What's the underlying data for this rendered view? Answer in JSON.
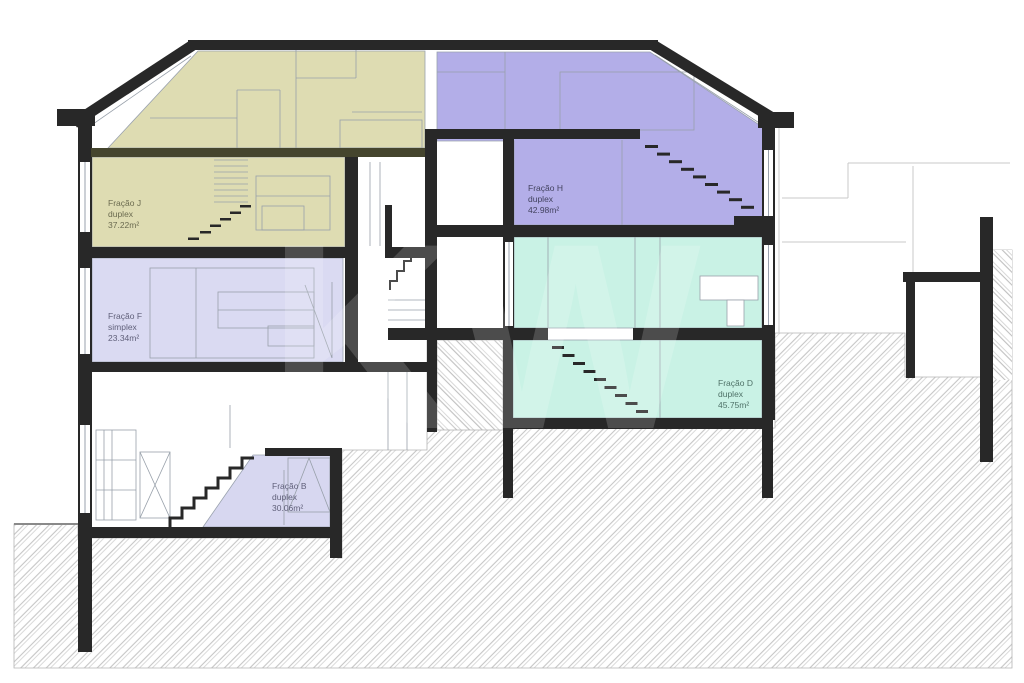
{
  "drawing": {
    "kind": "building cross-section",
    "watermark": "KW"
  },
  "colors": {
    "wall": "#282828",
    "attic_slab": "#45452e",
    "background": "#ffffff",
    "hatch_line": "#c6c6c6",
    "furniture_line": "#98a0aa",
    "neighbor_line": "#c9c9c9"
  },
  "units": [
    {
      "name": "Fração J",
      "type": "duplex",
      "area": "37.22m²",
      "color": "#dedcb2",
      "label_color": "#6b6b50"
    },
    {
      "name": "Fração F",
      "type": "simplex",
      "area": "23.34m²",
      "color": "#dadaf2",
      "label_color": "#60607a"
    },
    {
      "name": "Fração H",
      "type": "duplex",
      "area": "42.98m²",
      "color": "#b3aee8",
      "label_color": "#42425f"
    },
    {
      "name": "Fração D",
      "type": "duplex",
      "area": "45.75m²",
      "color": "#c9f2e5",
      "label_color": "#4f7268"
    },
    {
      "name": "Fração B",
      "type": "duplex",
      "area": "30.06m²",
      "color": "#d7d7f0",
      "label_color": "#60607a"
    }
  ]
}
